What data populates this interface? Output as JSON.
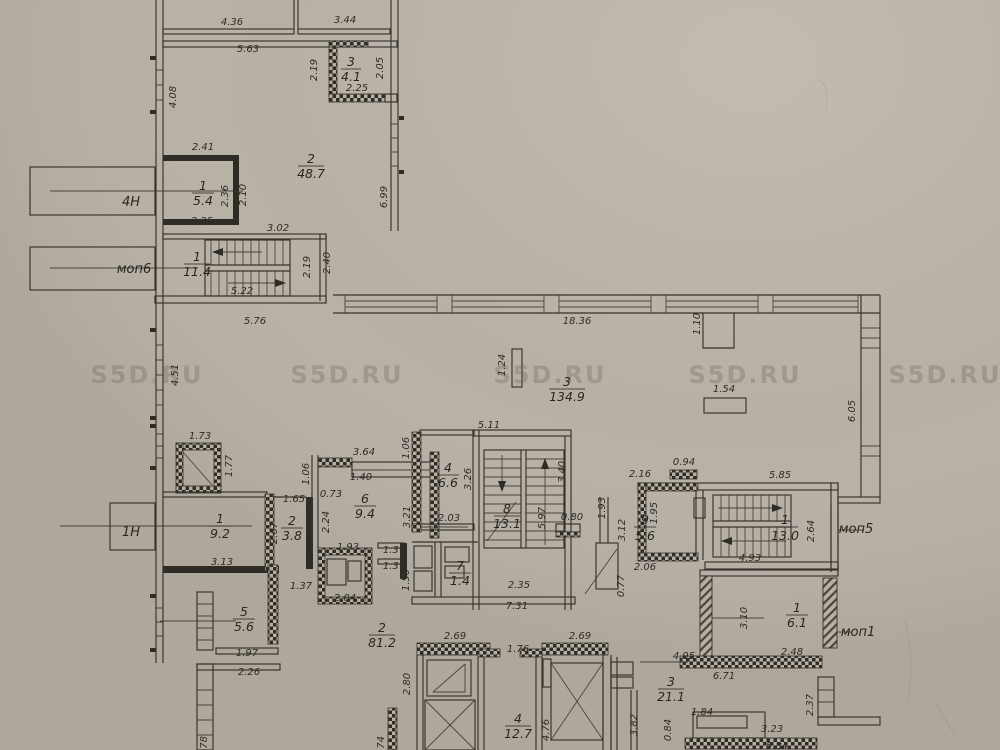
{
  "watermark": {
    "text": "S5D.RU"
  },
  "colors": {
    "paper": "#b7b0a5",
    "ink": "#36332b",
    "watermark": "#6e695f"
  },
  "outside_labels": [
    "4Н",
    "моп6",
    "1Н",
    "моп5",
    "моп1"
  ],
  "rooms": [
    {
      "n": "1",
      "a": "5.4"
    },
    {
      "n": "2",
      "a": "48.7"
    },
    {
      "n": "3",
      "a": "4.1"
    },
    {
      "n": "1",
      "a": "11.4"
    },
    {
      "n": "3",
      "a": "134.9"
    },
    {
      "n": "1",
      "a": "9.2"
    },
    {
      "n": "2",
      "a": "3.8"
    },
    {
      "n": "6",
      "a": "9.4"
    },
    {
      "n": "4",
      "a": "6.6"
    },
    {
      "n": "8",
      "a": "13.1"
    },
    {
      "n": "7",
      "a": "1.4"
    },
    {
      "n": "9",
      "a": "5.6"
    },
    {
      "n": "1",
      "a": "13.0"
    },
    {
      "n": "5",
      "a": "5.6"
    },
    {
      "n": "2",
      "a": "81.2"
    },
    {
      "n": "4",
      "a": "12.7"
    },
    {
      "n": "3",
      "a": "21.1"
    },
    {
      "n": "1",
      "a": "6.1"
    }
  ],
  "dims": [
    "4.36",
    "3.44",
    "5.63",
    "2.19",
    "2.05",
    "2.25",
    "4.08",
    "2.41",
    "2.36",
    "2.10",
    "6.99",
    "2.25",
    "3.02",
    "2.19",
    "2.40",
    "5.22",
    "5.76",
    "18.36",
    "1.10",
    "1.24",
    "1.54",
    "6.05",
    "4.51",
    "1.73",
    "1.77",
    "3.64",
    "1.06",
    "1.06",
    "1.40",
    "0.73",
    "2.24",
    "3.21",
    "1.65",
    "2.67",
    "3.13",
    "1.93",
    "1.37",
    "1.37",
    "1.50",
    "1.37",
    "2.04",
    "5.11",
    "3.26",
    "2.03",
    "3.40",
    "5.97",
    "0.80",
    "2.35",
    "7.31",
    "1.93",
    "3.12",
    "2.16",
    "1.95",
    "0.94",
    "2.06",
    "0.77",
    "5.85",
    "2.64",
    "4.93",
    "2.69",
    "1.76",
    "2.69",
    "2.80",
    "4.76",
    "4.95",
    "6.71",
    "3.82",
    "1.84",
    "0.84",
    "3.23",
    "5.84",
    "3.10",
    "2.48",
    "2.37",
    "1.97",
    "2.26",
    ".78",
    ".74"
  ]
}
